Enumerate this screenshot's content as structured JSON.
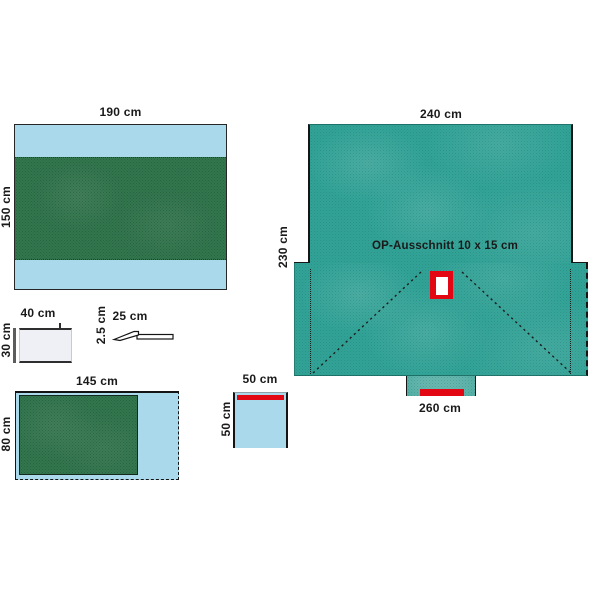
{
  "diagram": {
    "kind": "surgical-drape-set-dimension-diagram",
    "large_drape": {
      "width_label": "240 cm",
      "height_label": "230 cm",
      "bottom_width_label": "260 cm",
      "cutout_label": "OP-Ausschnitt 10 x 15 cm"
    },
    "drape_190": {
      "width_label": "190 cm",
      "height_label": "150 cm"
    },
    "absorbent_pad": {
      "width_label": "40 cm",
      "height_label": "30 cm"
    },
    "tape_strip": {
      "width_label": "25 cm",
      "height_label": "2.5 cm"
    },
    "drape_145": {
      "width_label": "145 cm",
      "height_label": "80 cm"
    },
    "small_drape": {
      "width_label": "50 cm",
      "height_label": "50 cm"
    },
    "colors": {
      "teal": "#3bb5a8",
      "light_blue": "#a9d9eb",
      "green": "#3f8a5c",
      "red": "#e30613",
      "outline": "#161616"
    }
  }
}
